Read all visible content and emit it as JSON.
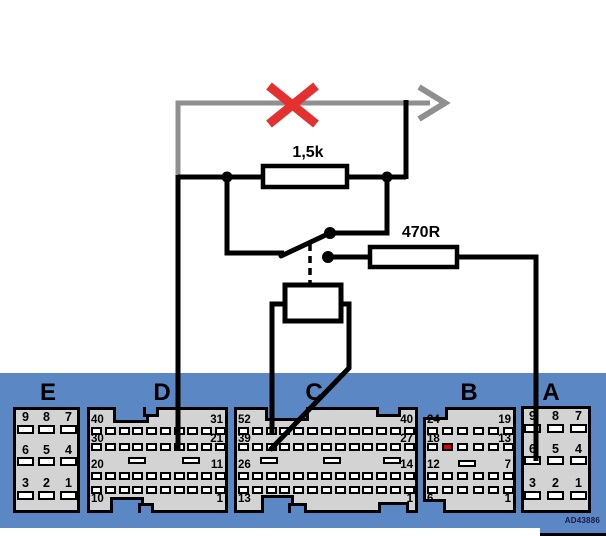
{
  "diagram_code": "AD43886",
  "labels": {
    "resistor_top": "1,5k",
    "resistor_right": "470R"
  },
  "colors": {
    "panel_blue": "#5b87c4",
    "connector_fill": "#d3d3d3",
    "wire_gray": "#8f8f8f",
    "cross_red": "#e53030",
    "highlight_pin_red": "#e60000"
  },
  "connectors": [
    {
      "id": "E",
      "label": "E",
      "type": "grid3",
      "pin_numbers": [
        [
          "9",
          "8",
          "7"
        ],
        [
          "6",
          "5",
          "4"
        ],
        [
          "3",
          "2",
          "1"
        ]
      ]
    },
    {
      "id": "D",
      "label": "D",
      "type": "rows",
      "pins_per_row": 10,
      "row_corner_labels": [
        [
          "40",
          "31"
        ],
        [
          "30",
          "21"
        ],
        [
          "20",
          "11"
        ],
        [
          "10",
          "1"
        ]
      ]
    },
    {
      "id": "C",
      "label": "C",
      "type": "rows",
      "pins_per_row": 13,
      "row_corner_labels": [
        [
          "52",
          "40"
        ],
        [
          "39",
          "27"
        ],
        [
          "26",
          "14"
        ],
        [
          "13",
          "1"
        ]
      ]
    },
    {
      "id": "B",
      "label": "B",
      "type": "rows",
      "pins_per_row": 6,
      "row_corner_labels": [
        [
          "24",
          "19"
        ],
        [
          "18",
          "13"
        ],
        [
          "12",
          "7"
        ],
        [
          "6",
          "1"
        ]
      ],
      "highlight_pin": {
        "row": 1,
        "index": 1
      }
    },
    {
      "id": "A",
      "label": "A",
      "type": "grid3",
      "pin_numbers": [
        [
          "9",
          "8",
          "7"
        ],
        [
          "6",
          "5",
          "4"
        ],
        [
          "3",
          "2",
          "1"
        ]
      ]
    }
  ]
}
